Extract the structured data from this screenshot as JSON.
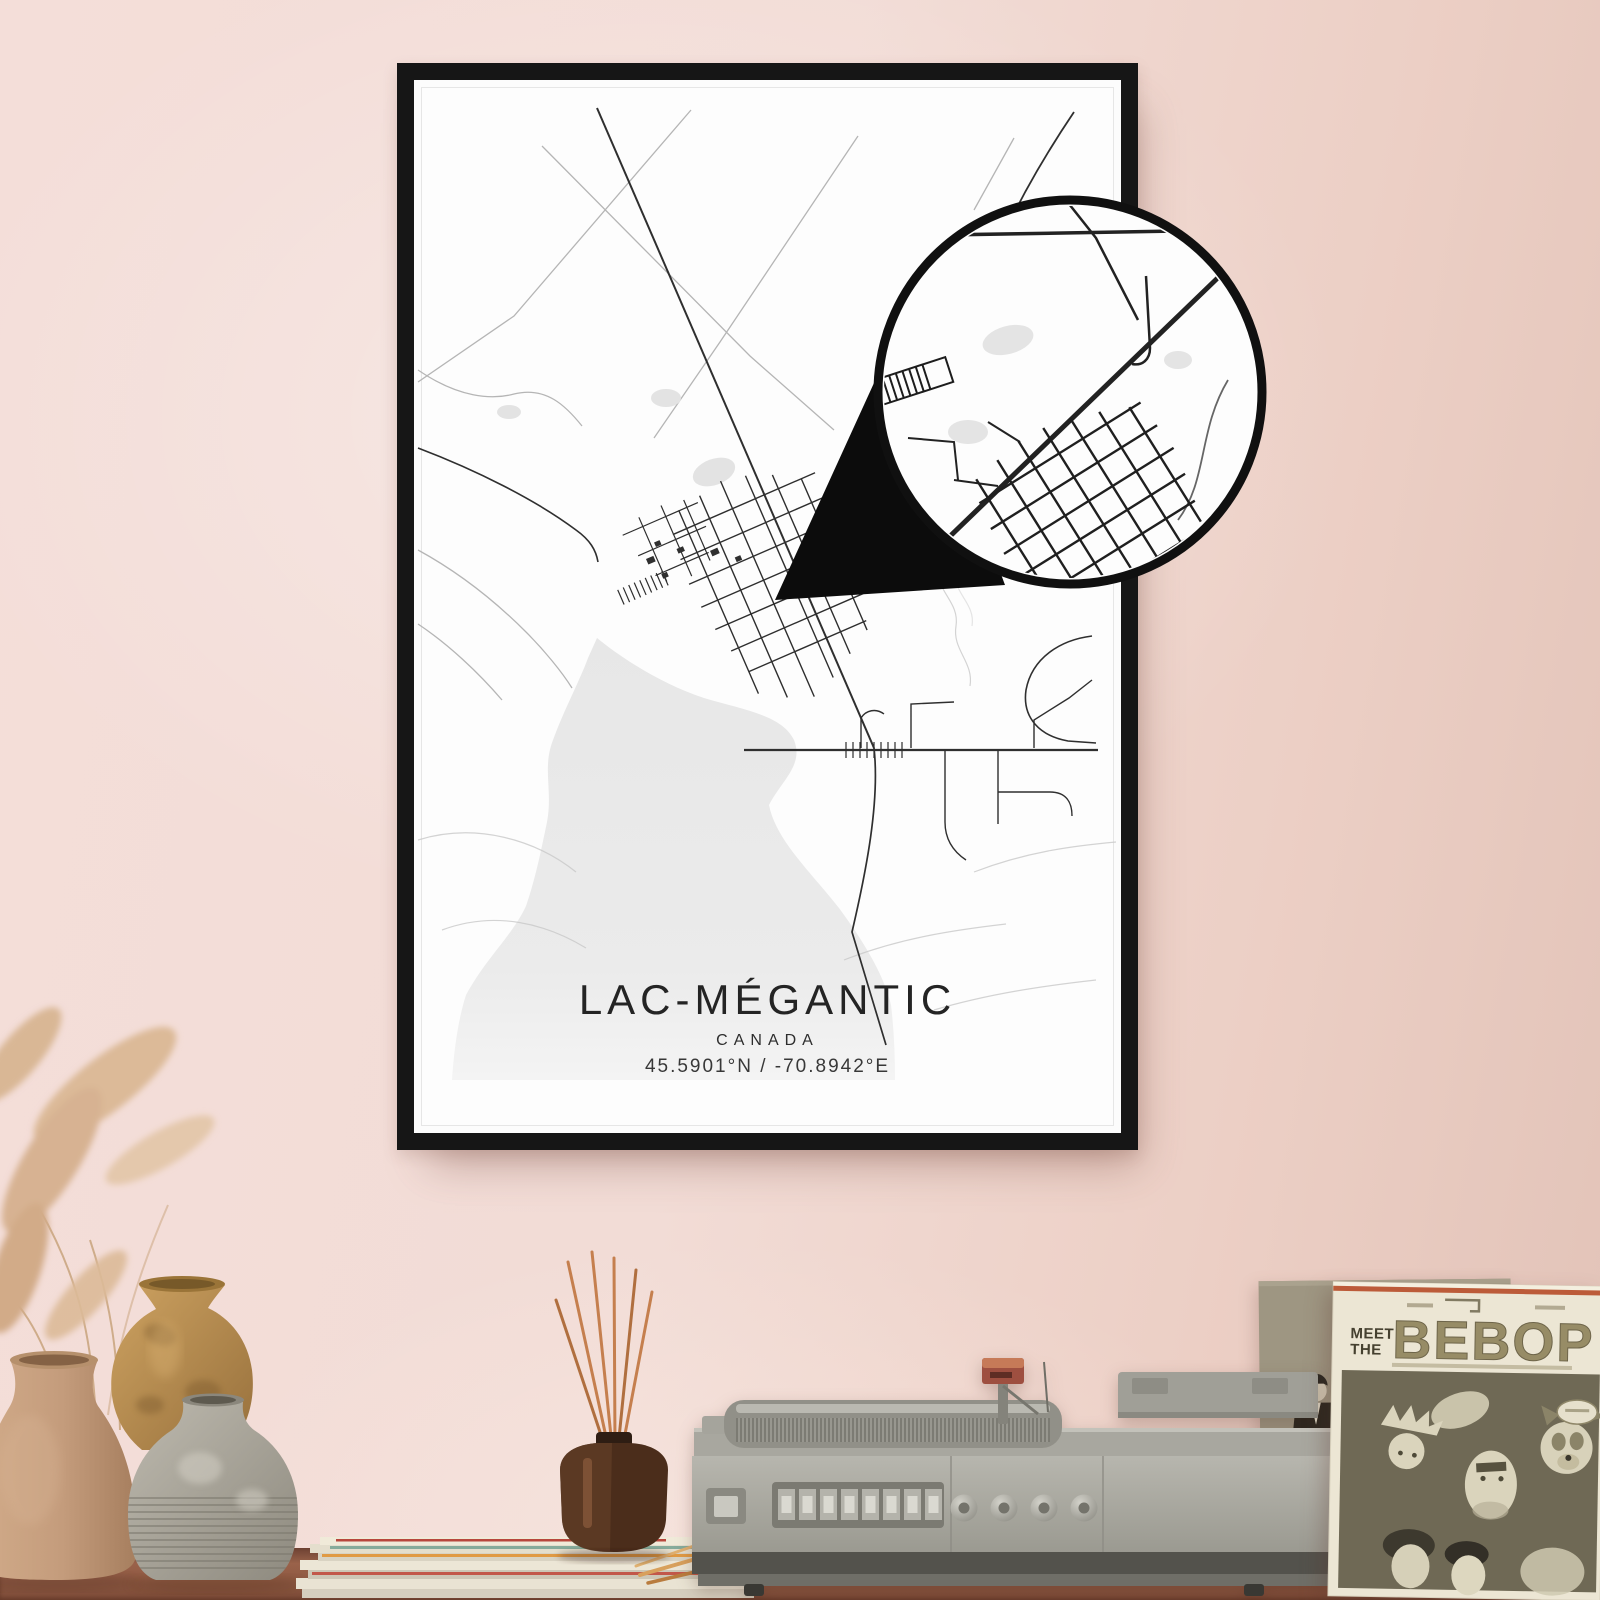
{
  "poster": {
    "title": "LAC-MÉGANTIC",
    "country": "CANADA",
    "coordinates": "45.5901°N / -70.8942°E"
  },
  "record_sleeve": {
    "title_top": "MEET",
    "title_mid": "THE",
    "title_main": "BEBOP"
  },
  "colors": {
    "wall": "#f2dcd6",
    "wall_shade": "#e2c3b8",
    "frame": "#161616",
    "poster_bg": "#fdfdfd",
    "map_road_dark": "#2f2f2f",
    "map_road_light": "#b8b8b8",
    "map_water": "#e9e9e9",
    "callout_ink": "#0c0c0c",
    "table_wood": "#8a5640",
    "sleeve_cream": "#ece6d4",
    "sleeve_photo_olive": "#6f6955",
    "sleeve_title_ink": "#978c66",
    "player_body": "#aeada5",
    "cartridge_red": "#b25a48",
    "reed_sticks": "#c57f4e",
    "diffuser_bottle": "#52331f",
    "vase_tan": "#c59e80",
    "vase_ochre": "#c0954f",
    "vase_gray": "#aaa69b",
    "pampas_grass": "#d9b897"
  }
}
